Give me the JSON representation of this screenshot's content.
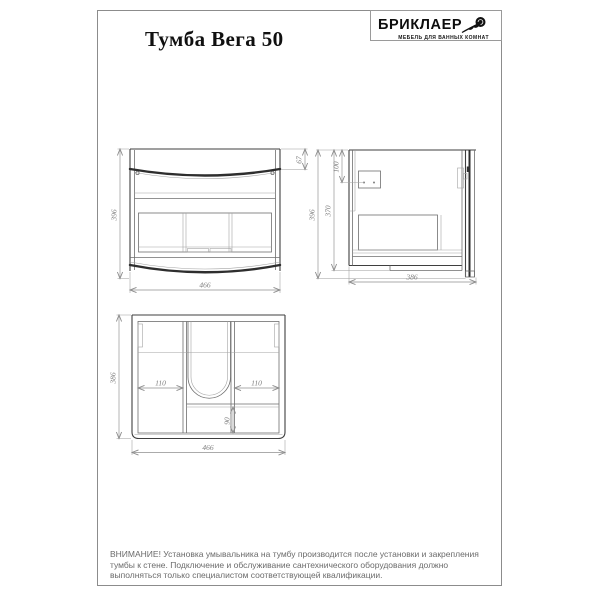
{
  "page": {
    "title": "Тумба Вега 50",
    "brand": {
      "name": "БРИКЛАЕР",
      "tagline": "МЕБЕЛЬ ДЛЯ ВАННЫХ КОМНАТ",
      "logo_icon": "rose-icon"
    },
    "warning": "ВНИМАНИЕ! Установка умывальника на тумбу производится после установки и закрепления тумбы к стене. Подключение и обслуживание сантехнического оборудования должно выполняться только специалистом соответствующей квалификации."
  },
  "views": {
    "front": {
      "height_mm": "396",
      "width_mm": "466",
      "top_panel_mm": "67"
    },
    "side": {
      "height_mm": "396",
      "body_height_mm": "370",
      "bracket_offset_mm": "100",
      "depth_mm": "386"
    },
    "top": {
      "depth_mm": "386",
      "width_mm": "466",
      "left_section_mm": "110",
      "right_section_mm": "110",
      "front_rail_mm": "90"
    }
  },
  "colors": {
    "drawing_line": "#3f3f3f",
    "dimension_line": "#8f8f8f",
    "sheet_border": "#8c8c8c",
    "warning_text": "#6b6b6b"
  }
}
